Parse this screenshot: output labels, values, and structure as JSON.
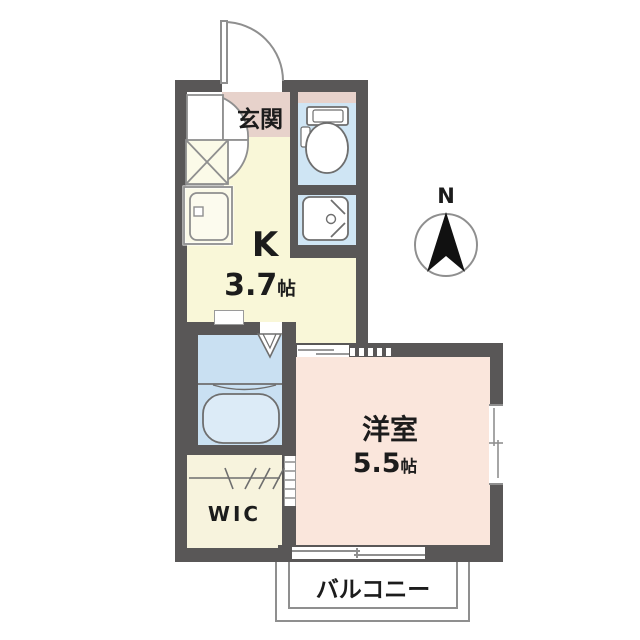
{
  "plan": {
    "entrance": {
      "label": "玄関"
    },
    "kitchen": {
      "label": "K",
      "area_value": "3.7",
      "area_unit": "帖"
    },
    "western_room": {
      "label": "洋室",
      "area_value": "5.5",
      "area_unit": "帖"
    },
    "wic": {
      "label": "WIC"
    },
    "balcony": {
      "label": "バルコニー"
    },
    "compass": {
      "label": "N"
    }
  },
  "colors": {
    "wall": "#595757",
    "entrance_floor": "#e7d2cb",
    "kitchen_floor": "#f9f7d8",
    "toilet_washbasin_floor": "#cfe5f4",
    "bath_floor": "#c9e0f2",
    "wic_floor": "#f7f3dd",
    "western_room_floor": "#fae6dc",
    "fixture_line": "#6e6e6e"
  }
}
